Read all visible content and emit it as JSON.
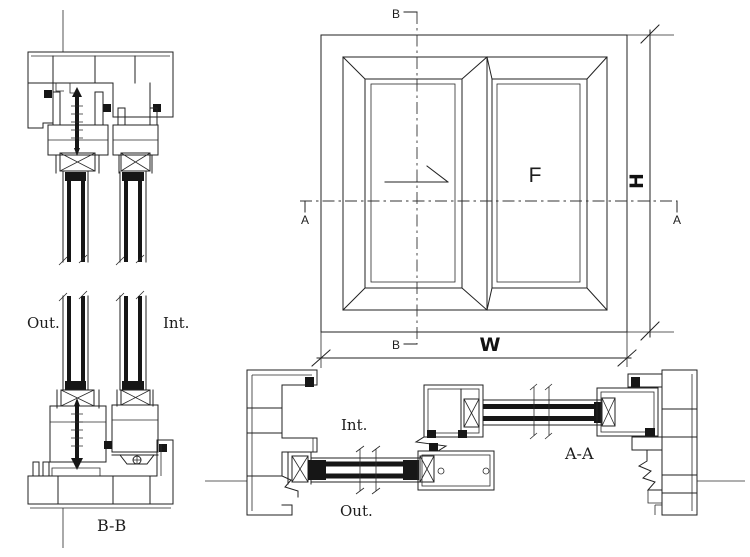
{
  "drawing_title": "Sliding aluminium window sections",
  "colors": {
    "background": "#ffffff",
    "line": "#222222",
    "solid_fill": "#161616"
  },
  "section_bb": {
    "caption": "B-B",
    "out": "Out.",
    "int": "Int."
  },
  "elevation": {
    "letter_a": "A",
    "letter_b": "B",
    "fixed_panel": "F",
    "width_dim": "W",
    "height_dim": "H"
  },
  "section_aa": {
    "caption": "A-A",
    "int": "Int.",
    "out": "Out."
  }
}
